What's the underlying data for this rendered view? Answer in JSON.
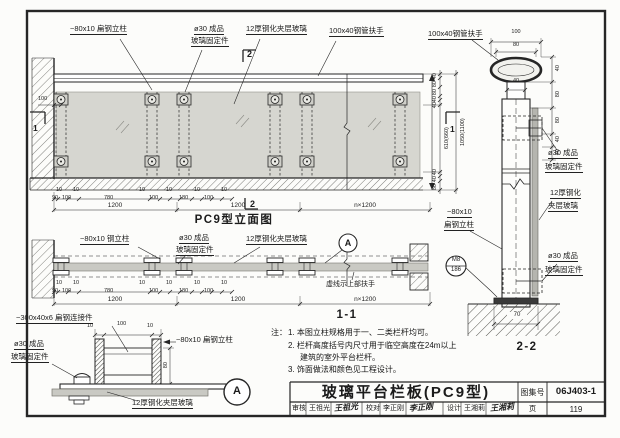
{
  "drawing": {
    "elevation": {
      "title": "PC9型立面图",
      "post_label": "−80x10 扁钢立柱",
      "fixing_label_1": "ø30  成品",
      "fixing_label_2": "玻璃固定件",
      "glass_label": "12厚钢化夹层玻璃",
      "handrail_label": "100x40钢管扶手",
      "wall_dim": "100",
      "section2_mark": "2",
      "section1_mark": "1",
      "chain": [
        "10",
        "90",
        "100",
        "10",
        "780",
        "10",
        "100",
        "10",
        "180",
        "10",
        "100",
        "10"
      ],
      "spans": [
        "1200",
        "1200",
        "n×1200"
      ],
      "vchain_top": [
        "40",
        "80",
        "80",
        "40",
        "40"
      ],
      "vchain_mid": "610(660)",
      "vchain_total": "1050(1100)",
      "vchain_bottom": [
        "40",
        "40",
        "80"
      ]
    },
    "section_1_1": {
      "title": "1-1",
      "post_label": "−80x10 钢立柱",
      "fixing_label_1": "ø30  成品",
      "fixing_label_2": "玻璃固定件",
      "glass_label": "12厚钢化夹层玻璃",
      "dashed_note": "虚线示上部扶手",
      "detail_mark": "A",
      "chain": [
        "10",
        "90",
        "100",
        "10",
        "780",
        "10",
        "100",
        "10",
        "180",
        "10",
        "100",
        "10"
      ],
      "spans": [
        "1200",
        "1200",
        "n×1200"
      ]
    },
    "detail_A": {
      "mark": "A",
      "connector_label": "−300x40x6  扁钢连接件",
      "fixing_label_1": "ø30  成品",
      "fixing_label_2": "玻璃固定件",
      "post_label": "−80x10 扁钢立柱",
      "glass_label": "12厚钢化夹层玻璃",
      "dim_top": [
        "10",
        "100",
        "10"
      ],
      "dim_side": "80"
    },
    "section_2_2": {
      "title": "2-2",
      "handrail_label": "100x40钢管扶手",
      "dim_100": "100",
      "dim_80": "80",
      "dim_40": "40",
      "vchain": [
        "40",
        "80",
        "80",
        "40",
        "40"
      ],
      "fixing_upper_1": "ø30  成品",
      "fixing_upper_2": "玻璃固定件",
      "glass_label_1": "12厚钢化",
      "glass_label_2": "夹层玻璃",
      "post_label_1": "−80x10",
      "post_label_2": "扁钢立柱",
      "fixing_lower_1": "ø30  成品",
      "fixing_lower_2": "玻璃固定件",
      "ref_top": "M8",
      "ref_bottom": "186",
      "dim_base": "70"
    },
    "notes": {
      "label": "注：",
      "line1": "1. 本图立柱规格用于一、二类栏杆均可。",
      "line2": "2. 栏杆高度括号内尺寸用于临空高度在24m以上",
      "line3": "建筑的室外平台栏杆。",
      "line4": "3. 饰面做法和颜色见工程设计。"
    },
    "titleblock": {
      "title": "玻璃平台栏板(PC9型)",
      "atlas_label": "图集号",
      "atlas_no": "06J403-1",
      "review_label": "审核",
      "review_name": "王祖光",
      "review_sig": "王祖光",
      "check_label": "校对",
      "check_name": "李正刚",
      "check_sig": "李正刚",
      "design_label": "设计",
      "design_name": "王湘莉",
      "design_sig": "王湘莉",
      "page_label": "页",
      "page_no": "119"
    },
    "colors": {
      "line": "#262626",
      "glass_fill": "#d6d6d0",
      "paper": "#fcfcfa"
    }
  }
}
